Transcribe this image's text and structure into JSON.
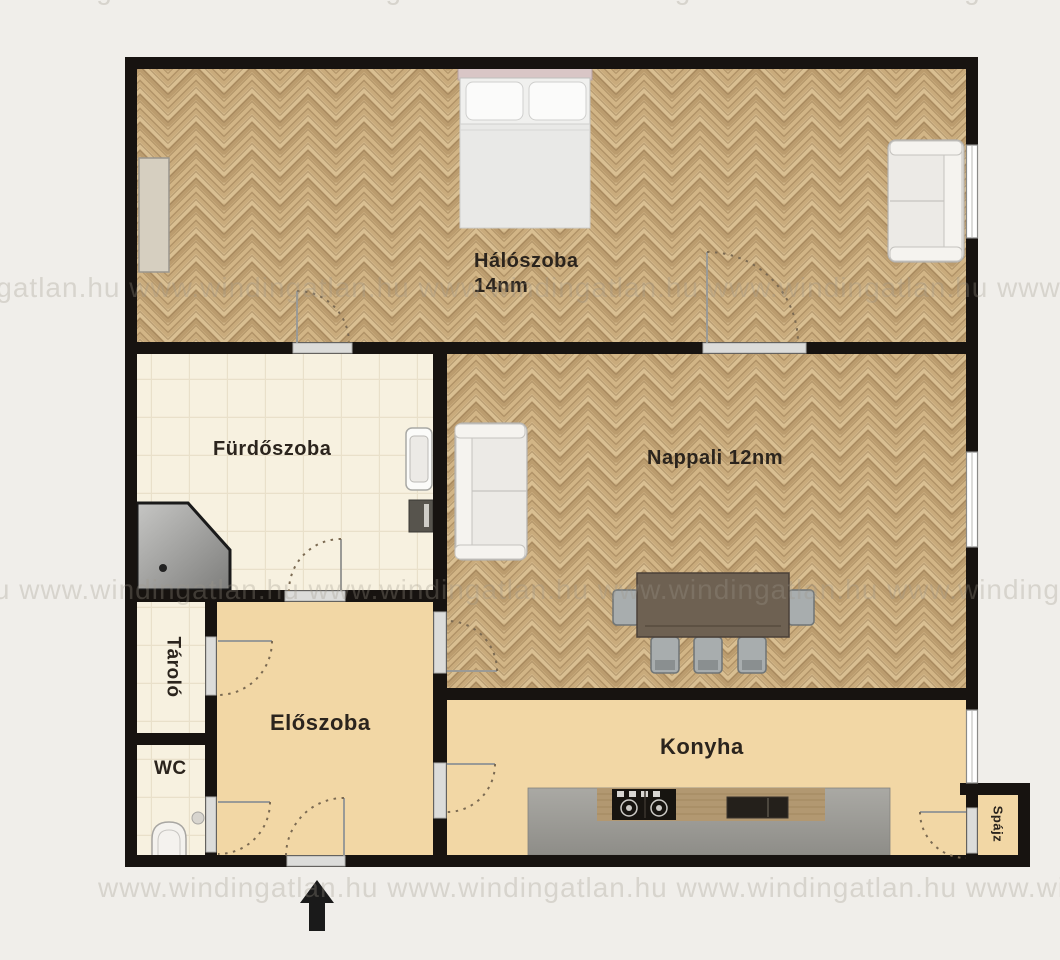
{
  "title": "Apartment floor plan",
  "watermark": {
    "text": "www.windingatlan.hu",
    "text_repeated": "www.windingatlan.hu  www.windingatlan.hu  www.windingatlan.hu  www.windingatlan.hu  www.windingatlan.hu  www.windingatlan.hu"
  },
  "rooms": {
    "bedroom": {
      "name": "Hálószoba",
      "area": "14nm"
    },
    "bathroom": {
      "name": "Fürdőszoba"
    },
    "living_room": {
      "name": "Nappali 12nm"
    },
    "hallway": {
      "name": "Előszoba"
    },
    "kitchen": {
      "name": "Konyha"
    },
    "wc": {
      "name": "WC"
    },
    "storage": {
      "name": "Tároló"
    },
    "pantry": {
      "name": "Spájz"
    }
  },
  "colors": {
    "background": "#f0eeea",
    "wall": "#171310",
    "wood_floor": "#cdb183",
    "tile_floor": "#f7f1e0",
    "tan_floor": "#f2d7a5",
    "label_text": "#2b241d",
    "watermark": "#c9c3ba"
  }
}
